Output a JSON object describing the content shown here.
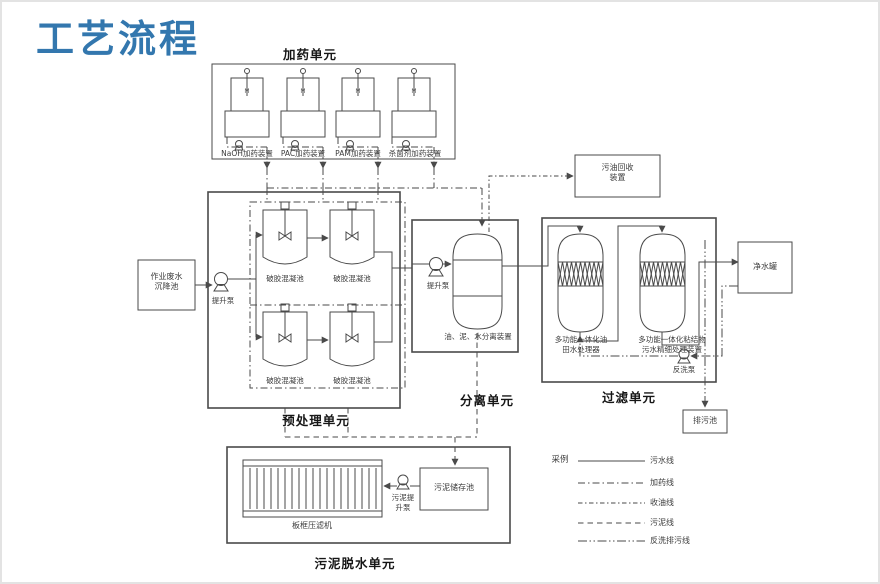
{
  "page_title": "工艺流程",
  "accent_color": "#3377ae",
  "dosing_unit": {
    "title": "加药单元",
    "motor_label": "M",
    "devices": [
      {
        "label": "NaOH加药装置"
      },
      {
        "label": "PAC加药装置"
      },
      {
        "label": "PAM加药装置"
      },
      {
        "label": "杀菌剂加药装置"
      }
    ]
  },
  "pretreatment_unit": {
    "title": "预处理单元",
    "source_tank": {
      "line1": "作业废水",
      "line2": "沉降池"
    },
    "pump": "提升泵",
    "tanks": [
      "破胶混凝池",
      "破胶混凝池",
      "破胶混凝池",
      "破胶混凝池"
    ]
  },
  "separation_unit": {
    "title": "分离单元",
    "pump": "提升泵",
    "vessel": "油、泥、水分离装置"
  },
  "filtration_unit": {
    "title": "过滤单元",
    "vessel1": {
      "line1": "多功能一体化油",
      "line2": "田水处理器"
    },
    "vessel2": {
      "line1": "多功能一体化粘结物",
      "line2": "污水精细处理装置"
    },
    "pump": "反洗泵"
  },
  "dewatering_unit": {
    "title": "污泥脱水单元",
    "press": "板框压滤机",
    "pump": {
      "line1": "污泥提",
      "line2": "升泵"
    },
    "storage": "污泥储存池"
  },
  "aux": {
    "oil_recovery": {
      "line1": "污油回收",
      "line2": "装置"
    },
    "clean_water_tank": "净水罐",
    "drain_pool": "排污池"
  },
  "legend": {
    "title": "采例",
    "items": [
      {
        "label": "污水线",
        "style": "solid"
      },
      {
        "label": "加药线",
        "style": "dash-dot"
      },
      {
        "label": "收油线",
        "style": "dash-dot-small"
      },
      {
        "label": "污泥线",
        "style": "dashed"
      },
      {
        "label": "反洗排污线",
        "style": "dash-dot-dot"
      }
    ]
  }
}
